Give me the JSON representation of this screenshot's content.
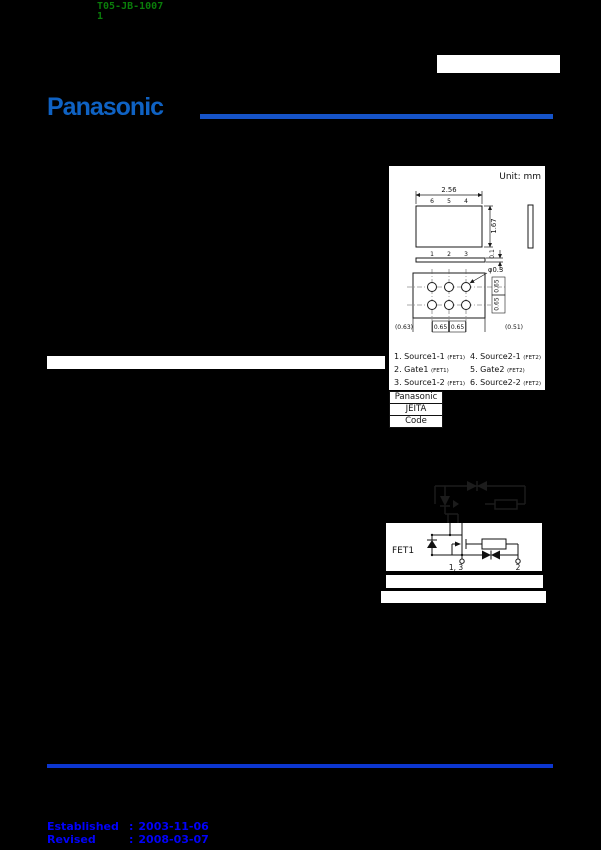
{
  "doc_header": {
    "doc_number": "T05-JB-1007",
    "doc_page": "1",
    "text_color": "#0a7c0a"
  },
  "brand": {
    "logo_text": "Panasonic",
    "logo_color": "#0f62c3",
    "rule_color": "#1553c8"
  },
  "package_diagram": {
    "unit_label": "Unit: mm",
    "top_view": {
      "width_dim": "2.56",
      "height_dim": "1.67",
      "pins_top": [
        "6",
        "5",
        "4"
      ],
      "pins_bottom": [
        "1",
        "2",
        "3"
      ]
    },
    "side_view": {
      "thickness_dim": "0.1"
    },
    "bottom_view": {
      "hole_dia_dim": "φ0.3",
      "row_pitch_dims": [
        "0.65",
        "0.65"
      ],
      "bottom_dims": [
        "(0.63)",
        "0.65",
        "0.65",
        "(0.51)"
      ]
    }
  },
  "pin_list": {
    "left_column": [
      {
        "label": "1. Source1-1",
        "suffix": "(FET1)"
      },
      {
        "label": "2. Gate1",
        "suffix": "(FET1)"
      },
      {
        "label": "3. Source1-2",
        "suffix": "(FET1)"
      }
    ],
    "right_column": [
      {
        "label": "4. Source2-1",
        "suffix": "(FET2)"
      },
      {
        "label": "5. Gate2",
        "suffix": "(FET2)"
      },
      {
        "label": "6. Source2-2",
        "suffix": "(FET2)"
      }
    ]
  },
  "code_table": {
    "rows": [
      "Panasonic",
      "JEITA",
      "Code"
    ]
  },
  "circuit": {
    "fet1_label": "FET1",
    "terminal_left_label": "1, 3",
    "terminal_right_label": "2"
  },
  "footer": {
    "rule_color": "#0c36d0",
    "text_color": "#0202fa",
    "established_label": "Established",
    "established_date": "2003-11-06",
    "revised_label": "Revised",
    "revised_date": "2008-03-07",
    "separator": ":"
  }
}
